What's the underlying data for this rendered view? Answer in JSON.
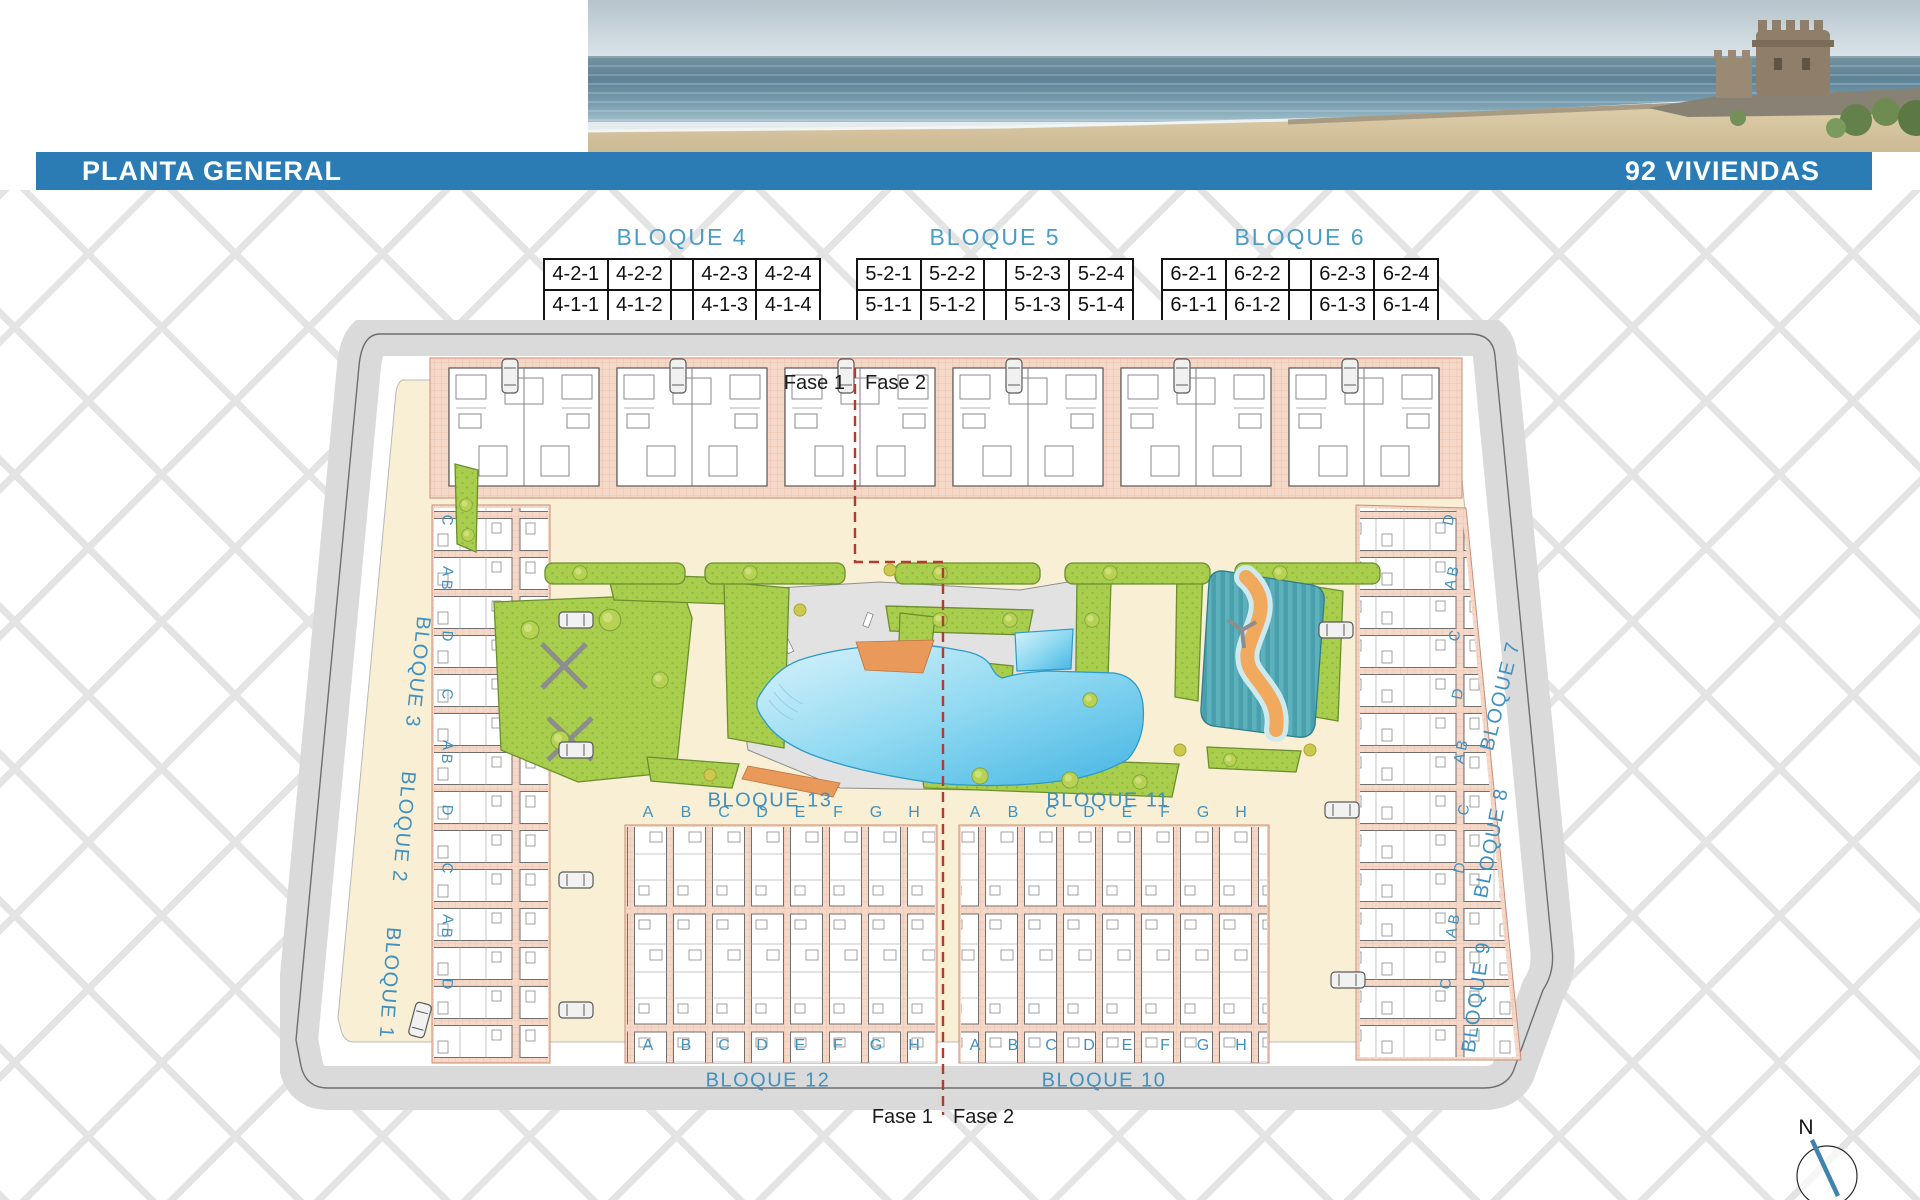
{
  "header": {
    "title": "PLANTA GENERAL",
    "units_count": "92 VIVIENDAS"
  },
  "tables": [
    {
      "title": "BLOQUE 4",
      "rows": [
        [
          "4-2-1",
          "4-2-2",
          "",
          "4-2-3",
          "4-2-4"
        ],
        [
          "4-1-1",
          "4-1-2",
          "",
          "4-1-3",
          "4-1-4"
        ],
        [
          "4-0-1",
          "4-0-2",
          "",
          "4-0-3",
          "4-0-4"
        ]
      ]
    },
    {
      "title": "BLOQUE 5",
      "rows": [
        [
          "5-2-1",
          "5-2-2",
          "",
          "5-2-3",
          "5-2-4"
        ],
        [
          "5-1-1",
          "5-1-2",
          "",
          "5-1-3",
          "5-1-4"
        ],
        [
          "5-0-1",
          "5-0-2",
          "",
          "5-0-3",
          "5-0-4"
        ]
      ]
    },
    {
      "title": "BLOQUE 6",
      "rows": [
        [
          "6-2-1",
          "6-2-2",
          "",
          "6-2-3",
          "6-2-4"
        ],
        [
          "6-1-1",
          "6-1-2",
          "",
          "6-1-3",
          "6-1-4"
        ],
        [
          "6-0-1",
          "6-0-2",
          "",
          "6-0-3",
          "6-0-4"
        ]
      ]
    }
  ],
  "plan": {
    "fase1": "Fase 1",
    "fase2": "Fase 2",
    "blocks": {
      "b1": "BLOQUE 1",
      "b2": "BLOQUE 2",
      "b3": "BLOQUE 3",
      "b7": "BLOQUE 7",
      "b8": "BLOQUE 8",
      "b9": "BLOQUE 9",
      "b10": "BLOQUE 10",
      "b11": "BLOQUE 11",
      "b12": "BLOQUE 12",
      "b13": "BLOQUE 13"
    },
    "unit_letters": [
      "A",
      "B",
      "C",
      "D",
      "E",
      "F",
      "G",
      "H"
    ],
    "left_letters": [
      "C",
      "A B",
      "D",
      "C",
      "A B",
      "D",
      "C",
      "A B",
      "D"
    ],
    "right_letters": [
      "D",
      "A B",
      "C",
      "D",
      "A B",
      "C",
      "D",
      "A B",
      "C"
    ],
    "compass_label": "N"
  },
  "colors": {
    "bar": "#2b7cb5",
    "label_blue": "#4191c0",
    "phase_red": "#b23b30"
  }
}
